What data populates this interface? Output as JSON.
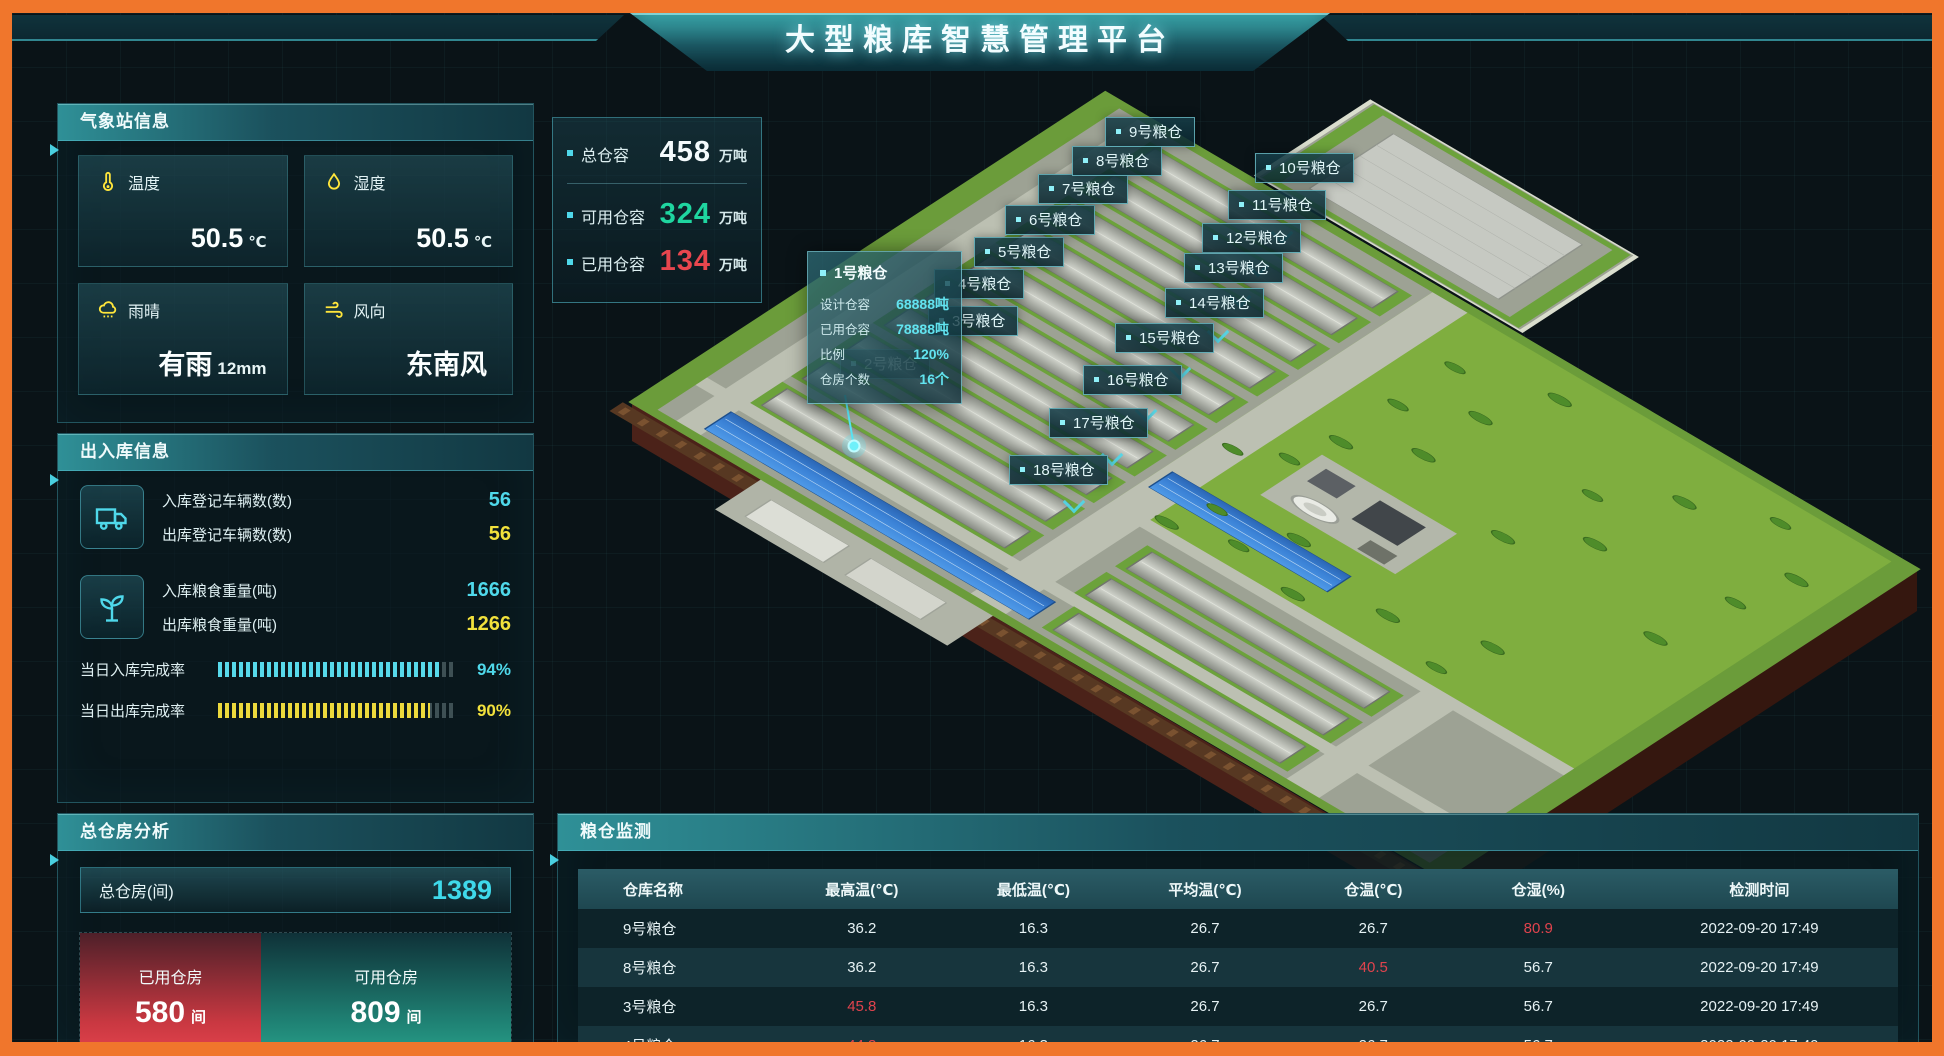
{
  "header": {
    "title": "大型粮库智慧管理平台"
  },
  "weather": {
    "title": "气象站信息",
    "cards": [
      {
        "icon": "thermometer-icon",
        "label": "温度",
        "value": "50.5",
        "unit": "℃"
      },
      {
        "icon": "droplet-icon",
        "label": "湿度",
        "value": "50.5",
        "unit": "℃"
      },
      {
        "icon": "rain-icon",
        "label": "雨晴",
        "value": "有雨",
        "unit": "12mm"
      },
      {
        "icon": "wind-icon",
        "label": "风向",
        "value": "东南风",
        "unit": ""
      }
    ]
  },
  "capacity": {
    "rows": [
      {
        "label": "总仓容",
        "value": "458",
        "unit": "万吨"
      },
      {
        "label": "可用仓容",
        "value": "324",
        "unit": "万吨"
      },
      {
        "label": "已用仓容",
        "value": "134",
        "unit": "万吨"
      }
    ]
  },
  "inout": {
    "title": "出入库信息",
    "vehicle_rows": [
      {
        "label": "入库登记车辆数(数)",
        "value": "56"
      },
      {
        "label": "出库登记车辆数(数)",
        "value": "56"
      }
    ],
    "grain_rows": [
      {
        "label": "入库粮食重量(吨)",
        "value": "1666"
      },
      {
        "label": "出库粮食重量(吨)",
        "value": "1266"
      }
    ],
    "progress": [
      {
        "label": "当日入库完成率",
        "percent": "94%"
      },
      {
        "label": "当日出库完成率",
        "percent": "90%"
      }
    ]
  },
  "analysis": {
    "title": "总仓房分析",
    "total_label": "总仓房(间)",
    "total_value": "1389",
    "used": {
      "label": "已用仓房",
      "value": "580",
      "unit": "间"
    },
    "available": {
      "label": "可用仓房",
      "value": "809",
      "unit": "间"
    }
  },
  "map": {
    "labels": [
      "2号粮仓",
      "3号粮仓",
      "4号粮仓",
      "5号粮仓",
      "6号粮仓",
      "7号粮仓",
      "8号粮仓",
      "9号粮仓",
      "10号粮仓",
      "11号粮仓",
      "12号粮仓",
      "13号粮仓",
      "14号粮仓",
      "15号粮仓",
      "16号粮仓",
      "17号粮仓",
      "18号粮仓"
    ],
    "tooltip": {
      "title": "1号粮仓",
      "rows": [
        {
          "label": "设计仓容",
          "value": "68888吨"
        },
        {
          "label": "已用仓容",
          "value": "78888吨"
        },
        {
          "label": "比例",
          "value": "120%"
        },
        {
          "label": "仓房个数",
          "value": "16个"
        }
      ]
    }
  },
  "monitor": {
    "title": "粮仓监测",
    "columns": [
      "仓库名称",
      "最高温(℃)",
      "最低温(℃)",
      "平均温(℃)",
      "仓温(℃)",
      "仓湿(%)",
      "检测时间"
    ],
    "rows": [
      {
        "cells": [
          {
            "v": "9号粮仓"
          },
          {
            "v": "36.2"
          },
          {
            "v": "16.3"
          },
          {
            "v": "26.7"
          },
          {
            "v": "26.7"
          },
          {
            "v": "80.9",
            "red": true
          },
          {
            "v": "2022-09-20 17:49"
          }
        ]
      },
      {
        "cells": [
          {
            "v": "8号粮仓"
          },
          {
            "v": "36.2"
          },
          {
            "v": "16.3"
          },
          {
            "v": "26.7"
          },
          {
            "v": "40.5",
            "red": true
          },
          {
            "v": "56.7"
          },
          {
            "v": "2022-09-20 17:49"
          }
        ]
      },
      {
        "cells": [
          {
            "v": "3号粮仓"
          },
          {
            "v": "45.8",
            "red": true
          },
          {
            "v": "16.3"
          },
          {
            "v": "26.7"
          },
          {
            "v": "26.7"
          },
          {
            "v": "56.7"
          },
          {
            "v": "2022-09-20 17:49"
          }
        ]
      },
      {
        "cells": [
          {
            "v": "4号粮仓"
          },
          {
            "v": "44.3",
            "red": true
          },
          {
            "v": "16.3"
          },
          {
            "v": "26.7"
          },
          {
            "v": "26.7"
          },
          {
            "v": "56.7"
          },
          {
            "v": "2022-09-20 17:49"
          }
        ]
      }
    ]
  }
}
